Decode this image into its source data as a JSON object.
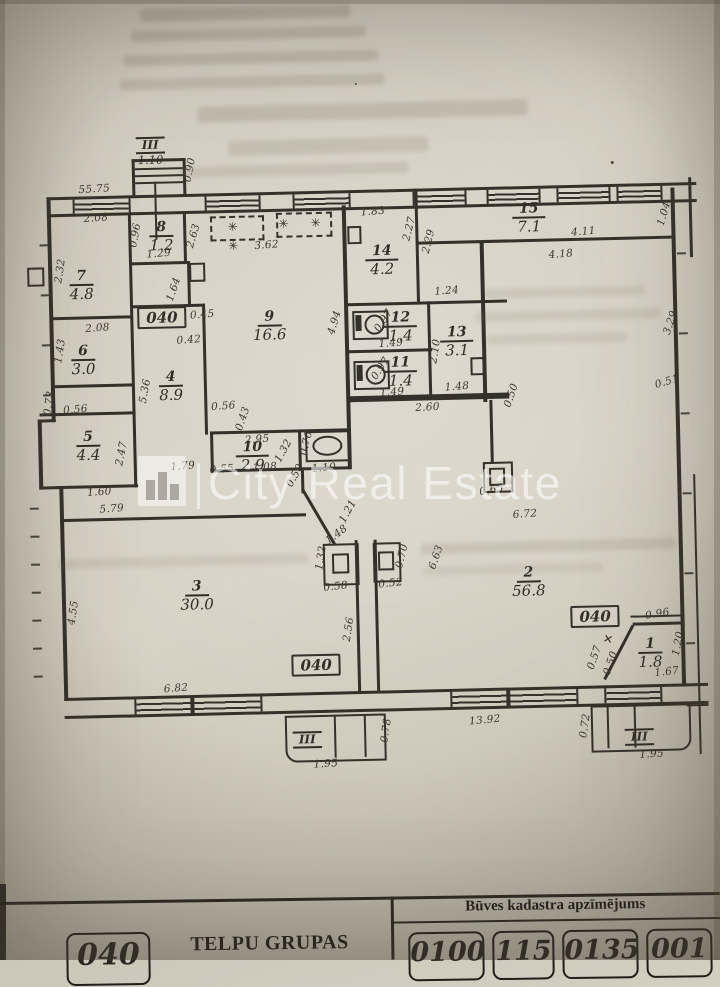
{
  "colors": {
    "paper": "#d3cdc0",
    "ink": "#34312a",
    "watermark": "rgba(255,255,255,0.58)"
  },
  "watermark": {
    "logo": "city-real-estate-logo",
    "text": "City Real Estate"
  },
  "symbols": {
    "stove": "✳ ✳",
    "cross": "✕"
  },
  "plan": {
    "rooms": [
      {
        "num": "7",
        "area": "4.8",
        "x": 85,
        "y": 277
      },
      {
        "num": "6",
        "area": "3.0",
        "x": 85,
        "y": 352
      },
      {
        "num": "5",
        "area": "4.4",
        "x": 88,
        "y": 438
      },
      {
        "num": "8",
        "area": "1.2",
        "x": 166,
        "y": 230
      },
      {
        "num": "4",
        "area": "8.9",
        "x": 172,
        "y": 380
      },
      {
        "num": "9",
        "area": "16.6",
        "x": 272,
        "y": 322
      },
      {
        "num": "10",
        "area": "2.9",
        "x": 252,
        "y": 452
      },
      {
        "num": "14",
        "area": "4.2",
        "x": 386,
        "y": 259
      },
      {
        "num": "15",
        "area": "7.1",
        "x": 534,
        "y": 220
      },
      {
        "num": "12",
        "area": "1.4",
        "x": 403,
        "y": 326
      },
      {
        "num": "11",
        "area": "1.4",
        "x": 402,
        "y": 371
      },
      {
        "num": "13",
        "area": "3.1",
        "x": 459,
        "y": 342
      },
      {
        "num": "3",
        "area": "30.0",
        "x": 193,
        "y": 590
      },
      {
        "num": "2",
        "area": "56.8",
        "x": 525,
        "y": 584
      },
      {
        "num": "1",
        "area": "1.8",
        "x": 645,
        "y": 658
      }
    ],
    "entries": [
      {
        "label": "III",
        "value": "1.10",
        "x": 157,
        "y": 129
      },
      {
        "label": "III",
        "value": "",
        "x": 300,
        "y": 727
      },
      {
        "label": "III",
        "value": "",
        "x": 632,
        "y": 732
      }
    ],
    "code_boxes": [
      {
        "label": "040",
        "x": 140,
        "y": 302
      },
      {
        "label": "040",
        "x": 286,
        "y": 653
      },
      {
        "label": "040",
        "x": 566,
        "y": 611
      }
    ],
    "dims": [
      {
        "t": "55.75",
        "x": 100,
        "y": 183,
        "r": -2
      },
      {
        "t": "0.90",
        "x": 196,
        "y": 166,
        "r": -78
      },
      {
        "t": "2.08",
        "x": 101,
        "y": 212,
        "r": -3
      },
      {
        "t": "2.32",
        "x": 64,
        "y": 264,
        "r": -80
      },
      {
        "t": "2.08",
        "x": 100,
        "y": 322,
        "r": -3
      },
      {
        "t": "1.43",
        "x": 62,
        "y": 344,
        "r": -80
      },
      {
        "t": "0.73",
        "x": 50,
        "y": 396,
        "r": -80
      },
      {
        "t": "0.56",
        "x": 76,
        "y": 403,
        "r": -3
      },
      {
        "t": "1.60",
        "x": 98,
        "y": 486,
        "r": -3
      },
      {
        "t": "5.79",
        "x": 110,
        "y": 503,
        "r": -3
      },
      {
        "t": "2.47",
        "x": 121,
        "y": 448,
        "r": -78
      },
      {
        "t": "0.96",
        "x": 140,
        "y": 230,
        "r": -78
      },
      {
        "t": "1.29",
        "x": 163,
        "y": 249,
        "r": -3
      },
      {
        "t": "1.64",
        "x": 177,
        "y": 285,
        "r": -70
      },
      {
        "t": "2.63",
        "x": 198,
        "y": 232,
        "r": -72
      },
      {
        "t": "3.62",
        "x": 271,
        "y": 243,
        "r": -3
      },
      {
        "t": "0.45",
        "x": 205,
        "y": 311,
        "r": -3
      },
      {
        "t": "0.42",
        "x": 191,
        "y": 336,
        "r": -3
      },
      {
        "t": "5.36",
        "x": 146,
        "y": 386,
        "r": -78
      },
      {
        "t": "0.56",
        "x": 224,
        "y": 403,
        "r": -3
      },
      {
        "t": "0.43",
        "x": 243,
        "y": 416,
        "r": -70
      },
      {
        "t": "1.79",
        "x": 182,
        "y": 462,
        "r": -3
      },
      {
        "t": "0.55",
        "x": 221,
        "y": 466,
        "r": -3
      },
      {
        "t": "2.95",
        "x": 257,
        "y": 437,
        "r": -3
      },
      {
        "t": "1.08",
        "x": 264,
        "y": 465,
        "r": -3
      },
      {
        "t": "1.32",
        "x": 283,
        "y": 449,
        "r": -60
      },
      {
        "t": "0.76",
        "x": 306,
        "y": 442,
        "r": -75
      },
      {
        "t": "0.50",
        "x": 294,
        "y": 474,
        "r": -60
      },
      {
        "t": "1.10",
        "x": 323,
        "y": 467,
        "r": -3
      },
      {
        "t": "4.94",
        "x": 337,
        "y": 322,
        "r": -72
      },
      {
        "t": "1.83",
        "x": 378,
        "y": 212,
        "r": -3
      },
      {
        "t": "2.27",
        "x": 414,
        "y": 230,
        "r": -75
      },
      {
        "t": "2.29",
        "x": 433,
        "y": 243,
        "r": -75
      },
      {
        "t": "4.11",
        "x": 588,
        "y": 237,
        "r": -3
      },
      {
        "t": "4.18",
        "x": 565,
        "y": 259,
        "r": -3
      },
      {
        "t": "1.04",
        "x": 669,
        "y": 221,
        "r": -72
      },
      {
        "t": "0.97",
        "x": 386,
        "y": 321,
        "r": -55
      },
      {
        "t": "1.49",
        "x": 393,
        "y": 344,
        "r": -3
      },
      {
        "t": "0.97",
        "x": 382,
        "y": 369,
        "r": -55
      },
      {
        "t": "1.49",
        "x": 393,
        "y": 393,
        "r": -3
      },
      {
        "t": "1.24",
        "x": 450,
        "y": 293,
        "r": -3
      },
      {
        "t": "2.10",
        "x": 437,
        "y": 353,
        "r": -80
      },
      {
        "t": "1.48",
        "x": 458,
        "y": 389,
        "r": -3
      },
      {
        "t": "2.60",
        "x": 428,
        "y": 409,
        "r": -2
      },
      {
        "t": "0.50",
        "x": 512,
        "y": 399,
        "r": -70
      },
      {
        "t": "3.29",
        "x": 673,
        "y": 330,
        "r": -70
      },
      {
        "t": "0.51",
        "x": 668,
        "y": 389,
        "r": -15
      },
      {
        "t": "6.72",
        "x": 523,
        "y": 518,
        "r": -3
      },
      {
        "t": "6.63",
        "x": 433,
        "y": 559,
        "r": -70
      },
      {
        "t": "0.65",
        "x": 490,
        "y": 493,
        "r": -10
      },
      {
        "t": "1.48",
        "x": 334,
        "y": 534,
        "r": -35
      },
      {
        "t": "1.21",
        "x": 346,
        "y": 511,
        "r": -60
      },
      {
        "t": "1.32",
        "x": 318,
        "y": 557,
        "r": -80
      },
      {
        "t": "0.58",
        "x": 332,
        "y": 586,
        "r": -5
      },
      {
        "t": "0.52",
        "x": 387,
        "y": 584,
        "r": -5
      },
      {
        "t": "0.70",
        "x": 399,
        "y": 557,
        "r": -75
      },
      {
        "t": "4.55",
        "x": 69,
        "y": 606,
        "r": -80
      },
      {
        "t": "2.56",
        "x": 344,
        "y": 629,
        "r": -80
      },
      {
        "t": "6.82",
        "x": 170,
        "y": 684,
        "r": -3
      },
      {
        "t": "13.92",
        "x": 478,
        "y": 723,
        "r": -4
      },
      {
        "t": "0.78",
        "x": 379,
        "y": 731,
        "r": -80
      },
      {
        "t": "0.72",
        "x": 578,
        "y": 731,
        "r": -80
      },
      {
        "t": "0.96",
        "x": 653,
        "y": 621,
        "r": -8
      },
      {
        "t": "0.57",
        "x": 589,
        "y": 663,
        "r": -70
      },
      {
        "t": "0.50",
        "x": 605,
        "y": 669,
        "r": -70
      },
      {
        "t": "1.67",
        "x": 661,
        "y": 679,
        "r": -5
      },
      {
        "t": "1.20",
        "x": 673,
        "y": 651,
        "r": -78
      },
      {
        "t": "1.95",
        "x": 318,
        "y": 763,
        "r": -2
      },
      {
        "t": "1.95",
        "x": 644,
        "y": 761,
        "r": -2
      }
    ]
  },
  "table": {
    "left_stamp": "040",
    "left_title": "TELPU GRUPAS",
    "header": "Būves kadastra apzīmējums",
    "stamps": [
      "0100",
      "115",
      "0135",
      "001"
    ]
  }
}
